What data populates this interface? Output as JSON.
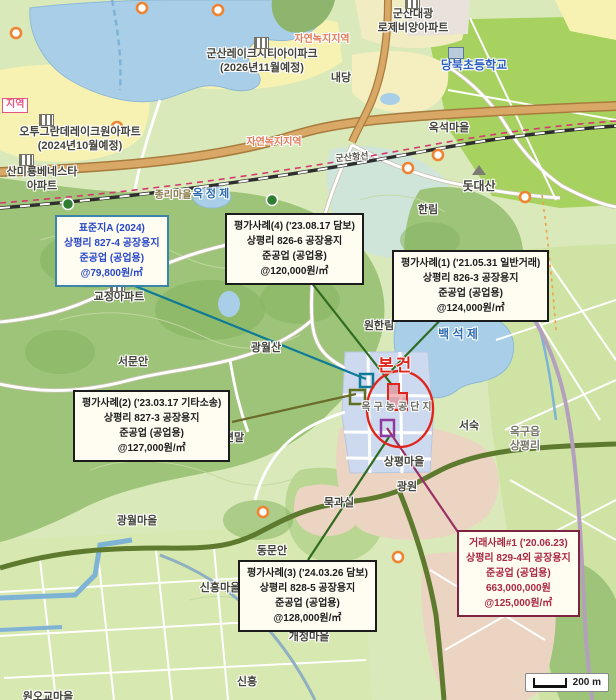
{
  "subject": {
    "text": "본건"
  },
  "scale_bar": {
    "label": "200 m"
  },
  "colors": {
    "subject_red": "#e0261c",
    "standard_site_border": "#3c85aa",
    "standard_site_text": "#2746c8",
    "appraisal_case_border": "#1c1c1c",
    "sale_case_border": "#7e2340",
    "sale_case_text": "#a82742",
    "water": "#a9cfe8",
    "industrial_complex": "#ccd9ee"
  },
  "callouts": [
    {
      "id": "standard-site-a",
      "x": 55,
      "y": 215,
      "border": "#3c85aa",
      "color": "#2746c8",
      "lines": [
        "표준지A (2024)",
        "상평리 827-4 공장용지",
        "준공업 (공업용)",
        "@79,800원/㎡"
      ]
    },
    {
      "id": "appraisal-case-4",
      "x": 225,
      "y": 213,
      "border": "#1c1c1c",
      "color": "#1c1c1c",
      "lines": [
        "평가사례(4) ('23.08.17 담보)",
        "상평리 826-6 공장용지",
        "준공업 (공업용)",
        "@120,000원/㎡"
      ]
    },
    {
      "id": "appraisal-case-1",
      "x": 392,
      "y": 250,
      "border": "#1c1c1c",
      "color": "#1c1c1c",
      "lines": [
        "평가사례(1) ('21.05.31 일반거래)",
        "상평리 826-3 공장용지",
        "준공업 (공업용)",
        "@124,000원/㎡"
      ]
    },
    {
      "id": "appraisal-case-2",
      "x": 73,
      "y": 390,
      "border": "#1c1c1c",
      "color": "#1c1c1c",
      "lines": [
        "평가사례(2) ('23.03.17 기타소송)",
        "상평리 827-3 공장용지",
        "준공업 (공업용)",
        "@127,000원/㎡"
      ]
    },
    {
      "id": "appraisal-case-3",
      "x": 238,
      "y": 560,
      "border": "#1c1c1c",
      "color": "#1c1c1c",
      "lines": [
        "평가사례(3) ('24.03.26 담보)",
        "상평리 828-5 공장용지",
        "준공업 (공업용)",
        "@128,000원/㎡"
      ]
    },
    {
      "id": "sale-case-1",
      "x": 457,
      "y": 530,
      "border": "#7e2340",
      "color": "#a82742",
      "lines": [
        "거래사례#1 ('20.06.23)",
        "상평리 829-4외 공장용지",
        "준공업 (공업용)",
        "663,000,000원",
        "@125,000원/㎡"
      ]
    }
  ],
  "labels": [
    {
      "id": "apt-gunsan-daegwang",
      "text": "군산대광\n로제비앙아파트",
      "x": 413,
      "y": 8
    },
    {
      "id": "apt-lakecity",
      "text": "군산레이크시티아이파크\n(2026년11월예정)",
      "x": 262,
      "y": 48
    },
    {
      "id": "school-dangbuk",
      "text": "당북초등학교",
      "x": 474,
      "y": 58,
      "color": "#2b5fc0",
      "size": 12
    },
    {
      "id": "naedang",
      "text": "내당",
      "x": 341,
      "y": 72
    },
    {
      "id": "zone-natural-green-top",
      "text": "자연녹지지역",
      "x": 322,
      "y": 34,
      "color": "#e07a5a",
      "size": 10
    },
    {
      "id": "zone-label-cut",
      "text": "지역",
      "x": 2,
      "y": 98,
      "color": "#e75480",
      "size": 10,
      "boxed": true
    },
    {
      "id": "apt-otwo-grande",
      "text": "오투그란데레이크원아파트\n(2024년10월예정)",
      "x": 80,
      "y": 126
    },
    {
      "id": "apt-benesta",
      "text": "산미룡베네스타\n아파트",
      "x": 42,
      "y": 166
    },
    {
      "id": "zone-natural-green-mid",
      "text": "자연녹지지역",
      "x": 274,
      "y": 137,
      "color": "#e07a5a",
      "size": 10
    },
    {
      "id": "okseok-village",
      "text": "옥석마을",
      "x": 449,
      "y": 122
    },
    {
      "id": "railway-name",
      "text": "군산항선",
      "x": 352,
      "y": 152,
      "color": "#5a5a52",
      "size": 9,
      "rotate": -5
    },
    {
      "id": "jongri-village",
      "text": "종리마을",
      "x": 173,
      "y": 190,
      "color": "#8a7a4a",
      "size": 10
    },
    {
      "id": "okjeongje-pond",
      "text": "옥 정 제",
      "x": 211,
      "y": 188,
      "color": "#2b6bb0",
      "size": 11
    },
    {
      "id": "dotdaesan-mountain",
      "text": "돗대산",
      "x": 479,
      "y": 179,
      "size": 12
    },
    {
      "id": "hallim",
      "text": "한림",
      "x": 428,
      "y": 204
    },
    {
      "id": "gyojeong-apt",
      "text": "교정아파트",
      "x": 119,
      "y": 291
    },
    {
      "id": "wonhallim",
      "text": "원한림",
      "x": 379,
      "y": 320
    },
    {
      "id": "baekseokje-lake",
      "text": "백 석 제",
      "x": 458,
      "y": 327,
      "color": "#2b6bb0",
      "size": 12
    },
    {
      "id": "seomunan",
      "text": "서문안",
      "x": 133,
      "y": 356
    },
    {
      "id": "gwangwolsan",
      "text": "광월산",
      "x": 266,
      "y": 342
    },
    {
      "id": "okgu-industrial-complex",
      "text": "옥구농공단지",
      "x": 398,
      "y": 402,
      "color": "#6a6a60",
      "spacing": 3,
      "size": 10
    },
    {
      "id": "seopyeonmal",
      "text": "서편말",
      "x": 229,
      "y": 432
    },
    {
      "id": "okgu-eup-sangpyeong-ri",
      "text": "옥구읍\n상평리",
      "x": 525,
      "y": 426,
      "color": "#77776b"
    },
    {
      "id": "seosuk",
      "text": "서숙",
      "x": 469,
      "y": 420
    },
    {
      "id": "sangpyeong-village",
      "text": "상평마을",
      "x": 404,
      "y": 456
    },
    {
      "id": "gwangwon",
      "text": "광원",
      "x": 407,
      "y": 481
    },
    {
      "id": "mukgwasil",
      "text": "묵과실",
      "x": 339,
      "y": 497
    },
    {
      "id": "gwangwol-village",
      "text": "광월마을",
      "x": 137,
      "y": 515
    },
    {
      "id": "dongmunan",
      "text": "동문안",
      "x": 272,
      "y": 545
    },
    {
      "id": "sinheung-village",
      "text": "신흥마을",
      "x": 220,
      "y": 582
    },
    {
      "id": "gaejeong-village",
      "text": "개정마을",
      "x": 309,
      "y": 631
    },
    {
      "id": "sinheung",
      "text": "신흥",
      "x": 247,
      "y": 676
    },
    {
      "id": "wonogyo-village",
      "text": "원오교마을",
      "x": 48,
      "y": 691
    }
  ],
  "icons": [
    {
      "name": "building-icon",
      "x": 405,
      "y": -3
    },
    {
      "name": "building-icon",
      "x": 254,
      "y": 37
    },
    {
      "name": "building-icon",
      "x": 39,
      "y": 114
    },
    {
      "name": "building-icon",
      "x": 19,
      "y": 154
    },
    {
      "name": "building-icon",
      "x": 110,
      "y": 280
    },
    {
      "name": "school-icon",
      "x": 448,
      "y": 47
    },
    {
      "name": "mountain-icon",
      "x": 472,
      "y": 165
    }
  ]
}
